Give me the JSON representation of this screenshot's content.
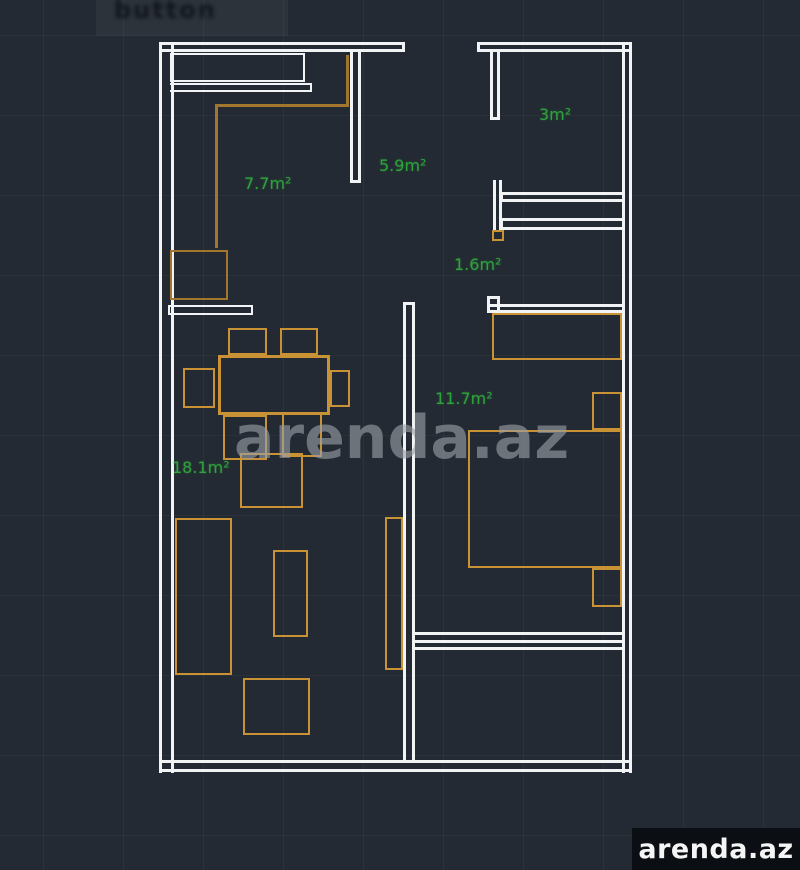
{
  "title": "Floor plan drawing (CAD style)",
  "colors": {
    "background": "#232a33",
    "wall": "#f2f3f4",
    "furniture": "#c99234",
    "furniture_dark": "#a3762e",
    "label_green": "#2fa23c",
    "watermark_gray": "#9aa0a7",
    "logo_bg": "#0b0e13",
    "logo_text": "#f5f5f5"
  },
  "rooms": {
    "kitchen": {
      "label": "7.7m²"
    },
    "hallway": {
      "label": "5.9m²"
    },
    "balcony": {
      "label": "3m²"
    },
    "corridor": {
      "label": "1.6m²"
    },
    "bedroom": {
      "label": "11.7m²"
    },
    "living": {
      "label": "18.1m²"
    }
  },
  "watermark": {
    "text": "arenda.az"
  },
  "logo": {
    "text": "arenda.az"
  },
  "top_left": {
    "text": "button"
  }
}
